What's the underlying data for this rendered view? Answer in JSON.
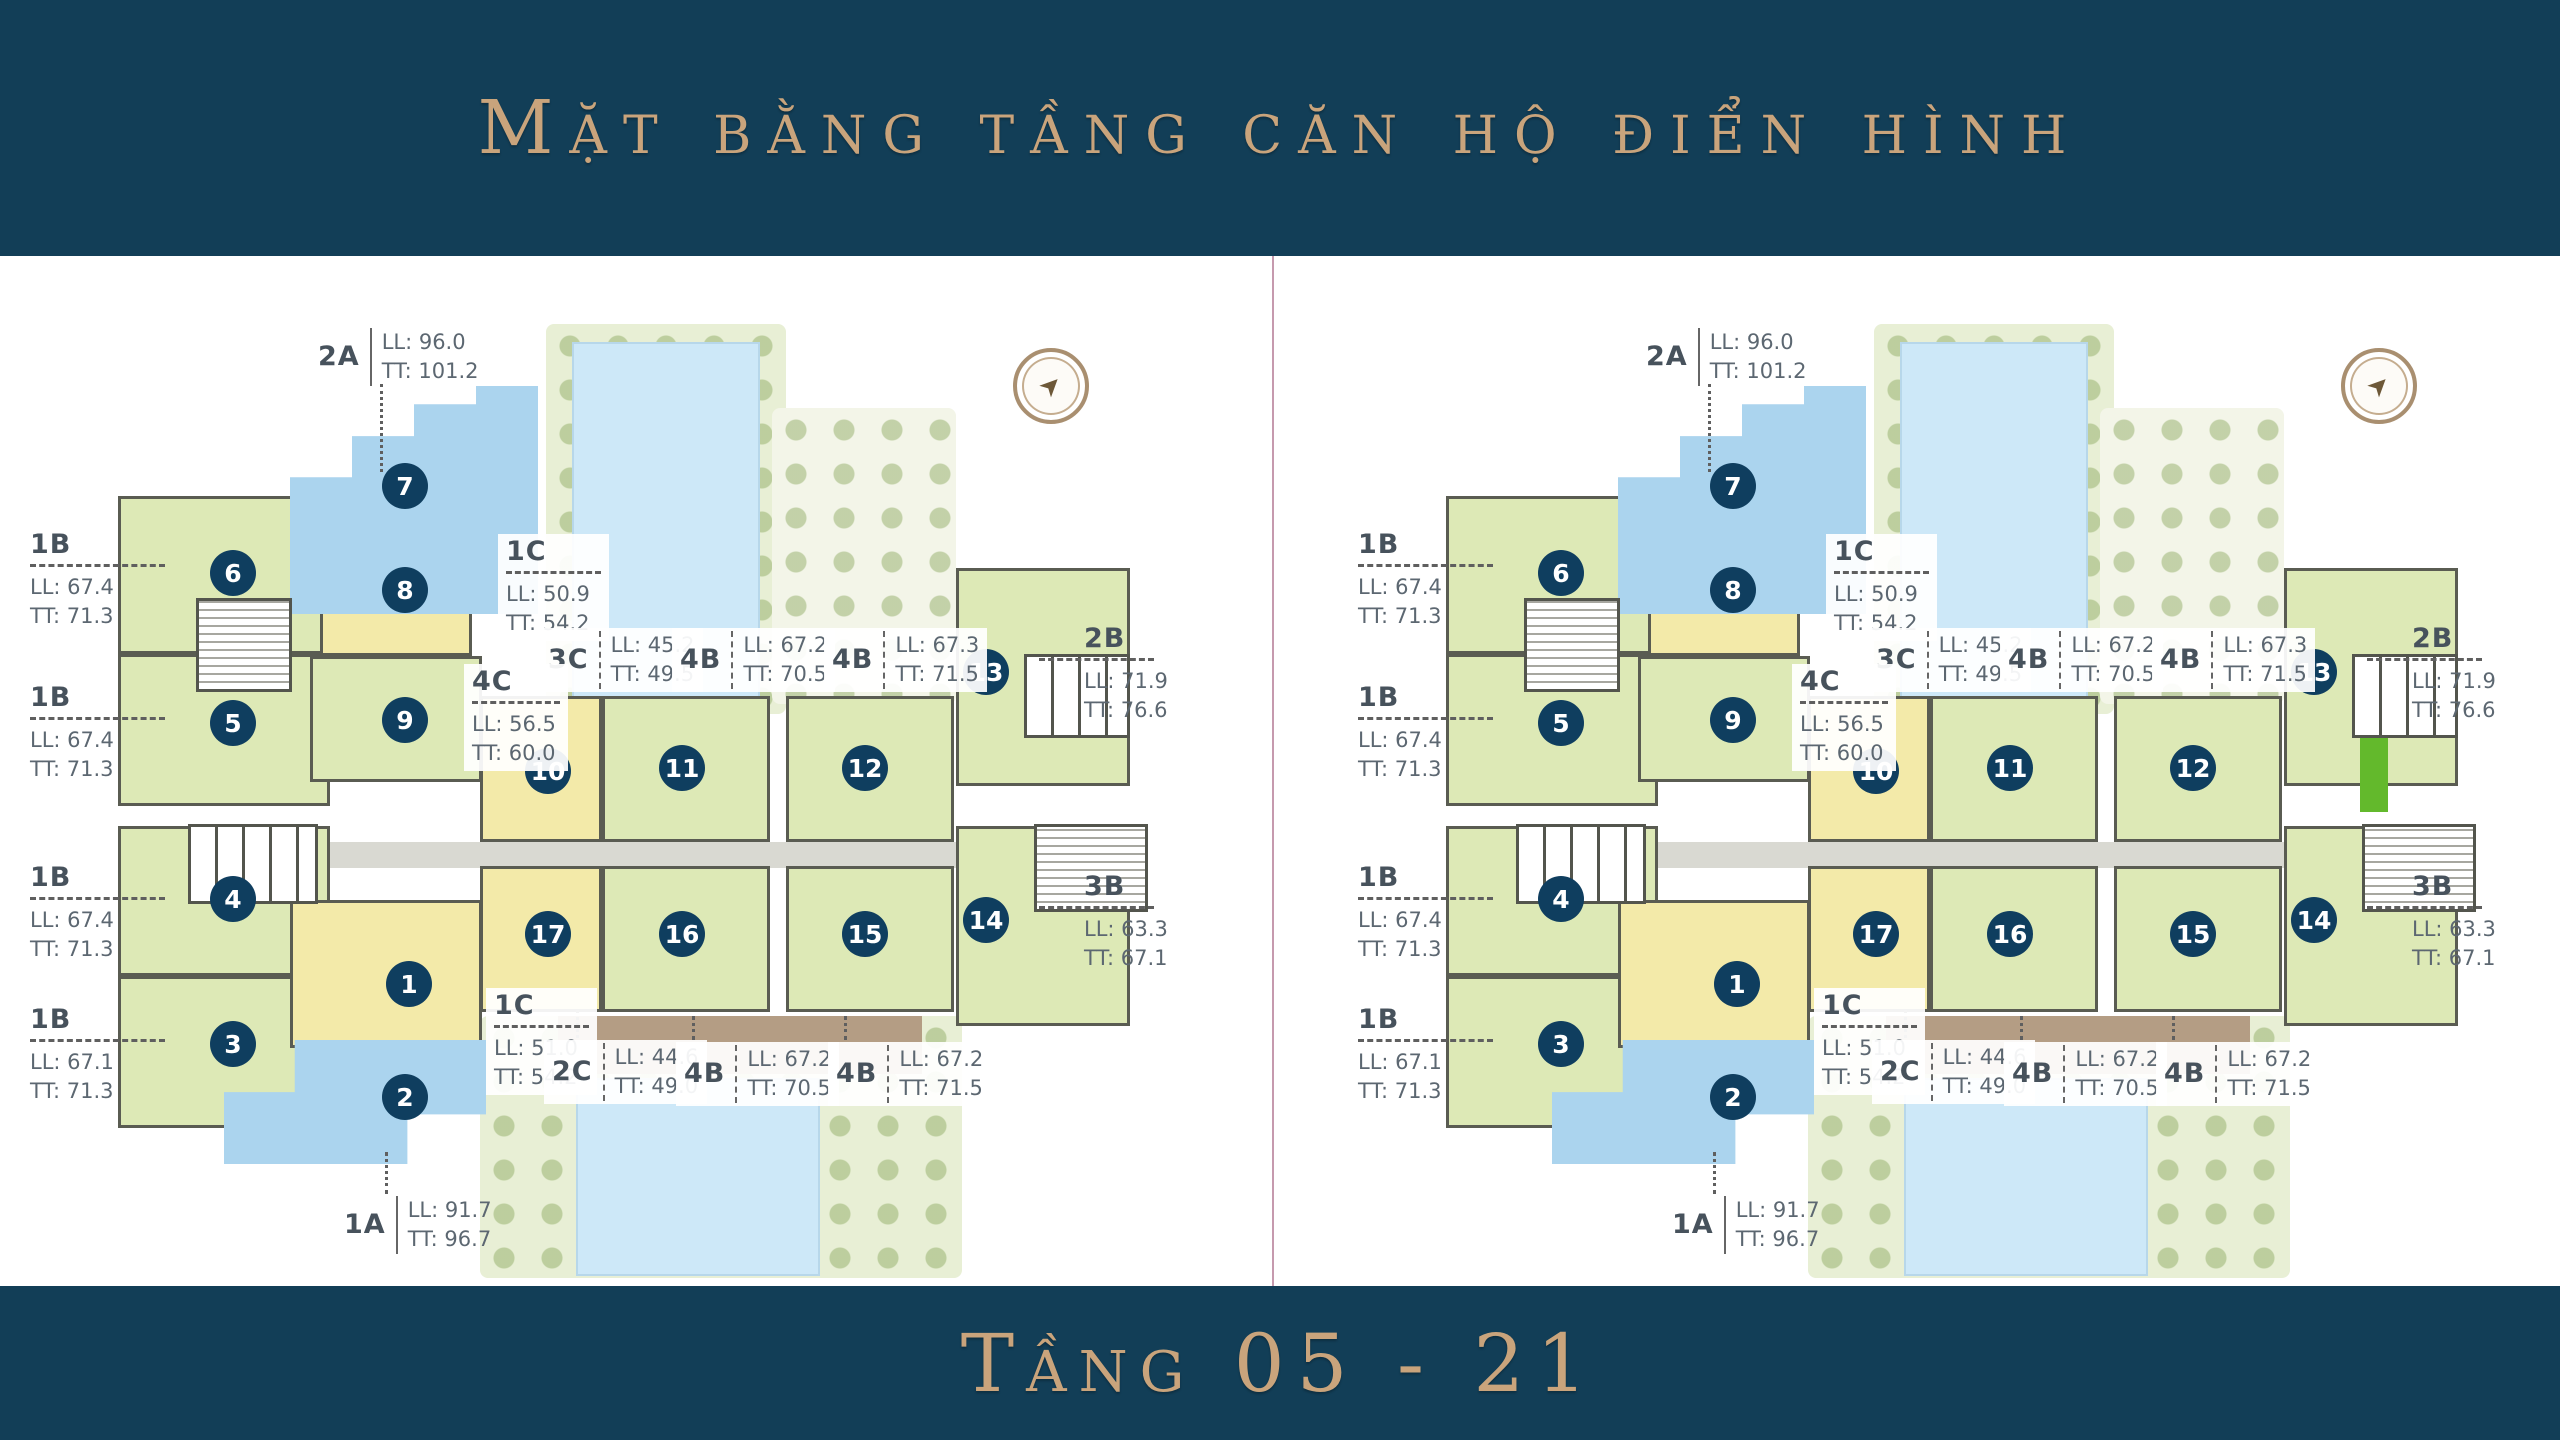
{
  "header": {
    "title": "Mặt bằng tầng căn hộ điển hình"
  },
  "footer": {
    "floor_range": "Tầng 05 - 21"
  },
  "colors": {
    "band_bg": "#123e57",
    "gold_text": "#c9a47c",
    "unit_green": "#dde9b6",
    "unit_yellow": "#f3eaa9",
    "unit_blue": "#abd4ee",
    "circle_navy": "#0f3e5f",
    "pool_blue": "#cde8f8",
    "highlight_green": "#63b92c",
    "divider_pink": "#a86482"
  },
  "plans": [
    {
      "side": "left",
      "has_highlight": false
    },
    {
      "side": "right",
      "has_highlight": true
    }
  ],
  "plan": {
    "landscape": [
      {
        "cls": "landscape",
        "r": [
          518,
          56,
          240,
          390
        ]
      },
      {
        "cls": "pool",
        "r": [
          544,
          74,
          188,
          356
        ]
      },
      {
        "cls": "landscape light",
        "r": [
          744,
          140,
          184,
          296
        ]
      },
      {
        "cls": "landscape",
        "r": [
          452,
          748,
          482,
          262
        ]
      },
      {
        "cls": "deck",
        "r": [
          530,
          748,
          364,
          58
        ]
      },
      {
        "cls": "pool",
        "r": [
          548,
          810,
          244,
          198
        ]
      }
    ],
    "corridors": [
      [
        158,
        574,
        950,
        26
      ]
    ],
    "units": [
      {
        "n": "6",
        "c": "green",
        "r": [
          90,
          228,
          212,
          158
        ]
      },
      {
        "n": "5",
        "c": "green",
        "r": [
          90,
          386,
          212,
          152
        ]
      },
      {
        "n": "4",
        "c": "green",
        "r": [
          90,
          558,
          212,
          150
        ]
      },
      {
        "n": "3",
        "c": "green",
        "r": [
          90,
          708,
          212,
          152
        ]
      },
      {
        "n": "8",
        "c": "yellow",
        "r": [
          292,
          256,
          152,
          132
        ]
      },
      {
        "n": "9",
        "c": "green",
        "r": [
          282,
          388,
          172,
          126
        ]
      },
      {
        "n": "1",
        "c": "yellow",
        "r": [
          262,
          632,
          192,
          148
        ]
      },
      {
        "n": "10",
        "c": "yellow",
        "r": [
          452,
          428,
          122,
          146
        ]
      },
      {
        "n": "11",
        "c": "green",
        "r": [
          574,
          428,
          168,
          146
        ]
      },
      {
        "n": "12",
        "c": "green",
        "r": [
          758,
          428,
          168,
          146
        ]
      },
      {
        "n": "13",
        "c": "green",
        "r": [
          928,
          300,
          174,
          218
        ]
      },
      {
        "n": "17",
        "c": "yellow",
        "r": [
          452,
          598,
          122,
          146
        ]
      },
      {
        "n": "16",
        "c": "green",
        "r": [
          574,
          598,
          168,
          146
        ]
      },
      {
        "n": "15",
        "c": "green",
        "r": [
          758,
          598,
          168,
          146
        ]
      },
      {
        "n": "14",
        "c": "green",
        "r": [
          928,
          558,
          174,
          200
        ]
      }
    ],
    "shapes": [
      {
        "name": "unit-7-2a-block",
        "r": [
          262,
          118,
          248,
          228
        ],
        "clip": "polygon(0% 40%, 25% 40%, 25% 22%, 50% 22%, 50% 8%, 75% 8%, 75% 0%, 100% 0%, 100% 100%, 0% 100%)"
      },
      {
        "name": "unit-2-block",
        "r": [
          196,
          772,
          262,
          124
        ],
        "clip": "polygon(27% 0%, 100% 0%, 100% 60%, 70% 60%, 70% 100%, 0% 100%, 0% 42%, 27% 42%)"
      }
    ],
    "cores": [
      {
        "cls": "stair",
        "r": [
          168,
          330,
          96,
          94
        ]
      },
      {
        "cls": "lift",
        "r": [
          160,
          556,
          130,
          80
        ]
      },
      {
        "cls": "lift",
        "r": [
          996,
          386,
          106,
          84
        ]
      },
      {
        "cls": "stair",
        "r": [
          1006,
          556,
          114,
          88
        ]
      }
    ],
    "highlight": {
      "r": [
        1004,
        470,
        28,
        74
      ]
    },
    "compass": {
      "x": 985,
      "y": 80,
      "d": 76,
      "needle": "➤"
    },
    "circles": [
      {
        "n": "1",
        "p": [
          381,
          716
        ]
      },
      {
        "n": "2",
        "p": [
          377,
          829
        ]
      },
      {
        "n": "3",
        "p": [
          205,
          776
        ]
      },
      {
        "n": "4",
        "p": [
          205,
          631
        ]
      },
      {
        "n": "5",
        "p": [
          205,
          455
        ]
      },
      {
        "n": "6",
        "p": [
          205,
          305
        ]
      },
      {
        "n": "7",
        "p": [
          377,
          218
        ]
      },
      {
        "n": "8",
        "p": [
          377,
          322
        ]
      },
      {
        "n": "9",
        "p": [
          377,
          452
        ]
      },
      {
        "n": "10",
        "p": [
          520,
          503
        ]
      },
      {
        "n": "11",
        "p": [
          654,
          500
        ]
      },
      {
        "n": "12",
        "p": [
          837,
          500
        ]
      },
      {
        "n": "13",
        "p": [
          958,
          404
        ]
      },
      {
        "n": "14",
        "p": [
          958,
          652
        ]
      },
      {
        "n": "15",
        "p": [
          837,
          666
        ]
      },
      {
        "n": "16",
        "p": [
          654,
          666
        ]
      },
      {
        "n": "17",
        "p": [
          520,
          666
        ]
      }
    ],
    "labels": [
      {
        "v": "inline",
        "t": "2A",
        "ll": "LL: 96.0",
        "tt": "TT: 101.2",
        "x": 290,
        "y": 60,
        "sep": "solid",
        "tick": [
          352,
          116,
          88
        ]
      },
      {
        "v": "stack",
        "t": "1B",
        "ll": "LL: 67.4",
        "tt": "TT: 71.3",
        "x": 2,
        "y": 262,
        "rw": 135
      },
      {
        "v": "stack",
        "t": "1B",
        "ll": "LL: 67.4",
        "tt": "TT: 71.3",
        "x": 2,
        "y": 415,
        "rw": 135
      },
      {
        "v": "stack",
        "t": "1B",
        "ll": "LL: 67.4",
        "tt": "TT: 71.3",
        "x": 2,
        "y": 595,
        "rw": 135
      },
      {
        "v": "stack",
        "t": "1B",
        "ll": "LL: 67.1",
        "tt": "TT: 71.3",
        "x": 2,
        "y": 737,
        "rw": 135
      },
      {
        "v": "stack",
        "t": "1C",
        "ll": "LL: 50.9",
        "tt": "TT: 54.2",
        "x": 470,
        "y": 266,
        "rw": 95,
        "bg": true
      },
      {
        "v": "inline",
        "t": "3C",
        "ll": "LL: 45.2",
        "tt": "TT: 49.5",
        "x": 512,
        "y": 360,
        "bg": true
      },
      {
        "v": "inline",
        "t": "4B",
        "ll": "LL: 67.2",
        "tt": "TT: 70.5",
        "x": 644,
        "y": 360,
        "bg": true
      },
      {
        "v": "inline",
        "t": "4B",
        "ll": "LL: 67.3",
        "tt": "TT: 71.5",
        "x": 796,
        "y": 360,
        "bg": true
      },
      {
        "v": "stack",
        "t": "4C",
        "ll": "LL: 56.5",
        "tt": "TT: 60.0",
        "x": 436,
        "y": 396,
        "rw": 88,
        "bg": true
      },
      {
        "v": "stack",
        "t": "2B",
        "ll": "LL: 71.9",
        "tt": "TT: 76.6",
        "x": 1056,
        "y": 356,
        "rw": 115,
        "rmx": -45
      },
      {
        "v": "stack",
        "t": "3B",
        "ll": "LL: 63.3",
        "tt": "TT: 67.1",
        "x": 1056,
        "y": 604,
        "rw": 115,
        "rmx": -45
      },
      {
        "v": "stack",
        "t": "1C",
        "ll": "LL: 51.0",
        "tt": "TT: 54.2",
        "x": 458,
        "y": 720,
        "rw": 95,
        "bg": true
      },
      {
        "v": "inline",
        "t": "2C",
        "ll": "LL: 44.6",
        "tt": "TT: 49.0",
        "x": 516,
        "y": 772,
        "bg": true,
        "tick": [
          548,
          742,
          28
        ]
      },
      {
        "v": "inline",
        "t": "4B",
        "ll": "LL: 67.2",
        "tt": "TT: 70.5",
        "x": 648,
        "y": 774,
        "bg": true,
        "tick": [
          664,
          748,
          24
        ]
      },
      {
        "v": "inline",
        "t": "4B",
        "ll": "LL: 67.2",
        "tt": "TT: 71.5",
        "x": 800,
        "y": 774,
        "bg": true,
        "tick": [
          816,
          748,
          24
        ]
      },
      {
        "v": "inline",
        "t": "1A",
        "ll": "LL: 91.7",
        "tt": "TT: 96.7",
        "x": 316,
        "y": 928,
        "sep": "solid",
        "tick": [
          357,
          884,
          42
        ]
      }
    ]
  }
}
